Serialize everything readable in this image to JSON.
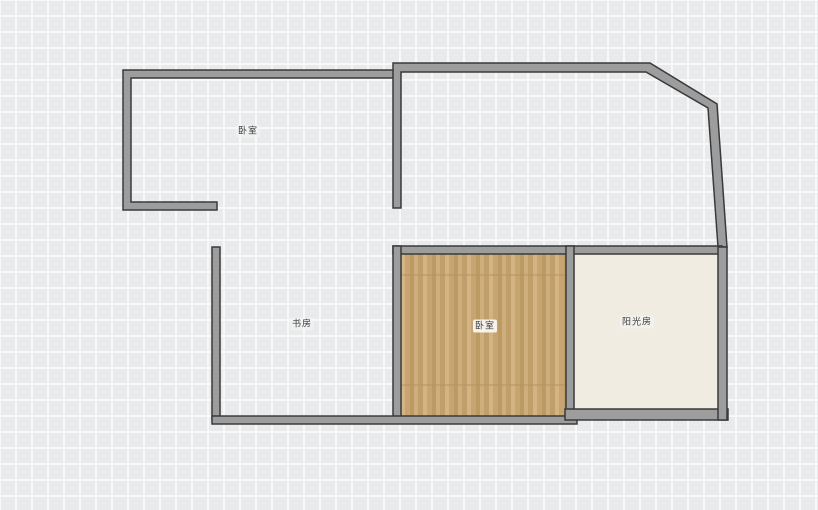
{
  "canvas": {
    "type": "floor-plan-canvas",
    "grid_cell_px": 16
  },
  "rooms": [
    {
      "id": "bedroom-top-left",
      "label": "卧室",
      "floor": "none"
    },
    {
      "id": "study",
      "label": "书房",
      "floor": "none"
    },
    {
      "id": "bedroom-main",
      "label": "卧室",
      "floor": "wood"
    },
    {
      "id": "sunroom",
      "label": "阳光房",
      "floor": "tile"
    }
  ],
  "colors": {
    "grid_background": "#e9eaec",
    "grid_line": "#f7f8f9",
    "wall_fill": "#9d9d9d",
    "wall_stroke": "#3a3a3a",
    "wood_floor_base": "#c9a977",
    "sunroom_floor": "#f0ece2",
    "label_text": "#3a3a3a"
  }
}
